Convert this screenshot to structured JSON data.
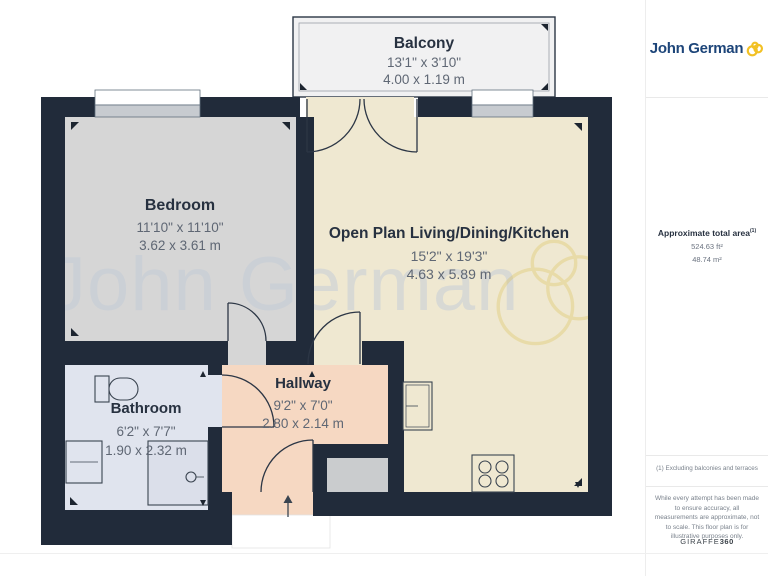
{
  "brand": {
    "name": "John German",
    "logo_color": "#1d4579",
    "swirl_color": "#f2c125"
  },
  "rooms": {
    "balcony": {
      "name": "Balcony",
      "imperial": "13'1\" x 3'10\"",
      "metric": "4.00 x 1.19 m"
    },
    "bedroom": {
      "name": "Bedroom",
      "imperial": "11'10\" x 11'10\"",
      "metric": "3.62 x 3.61 m"
    },
    "living": {
      "name": "Open Plan Living/Dining/Kitchen",
      "imperial": "15'2\" x 19'3\"",
      "metric": "4.63 x 5.89 m"
    },
    "hallway": {
      "name": "Hallway",
      "imperial": "9'2\" x 7'0\"",
      "metric": "2.80 x 2.14 m"
    },
    "bathroom": {
      "name": "Bathroom",
      "imperial": "6'2\" x 7'7\"",
      "metric": "1.90 x 2.32 m"
    }
  },
  "sidebar": {
    "area_title": "Approximate total area",
    "area_title_sup": "(1)",
    "area_ft": "524.63 ft²",
    "area_m": "48.74 m²",
    "footnote": "(1) Excluding balconies and terraces",
    "disclaimer": "While every attempt has been made to ensure accuracy, all measurements are approximate, not to scale. This floor plan is for illustrative purposes only.",
    "provider": "GIRAFFE",
    "provider_suffix": "360"
  },
  "watermark": {
    "text": "John German"
  },
  "colors": {
    "wall": "#212b3a",
    "bedroom": "#d6d6d6",
    "living": "#efe8d1",
    "hallway": "#f6d8c2",
    "bathroom": "#e0e4ee",
    "balcony": "#f1f1f2",
    "storage": "#caccce"
  }
}
